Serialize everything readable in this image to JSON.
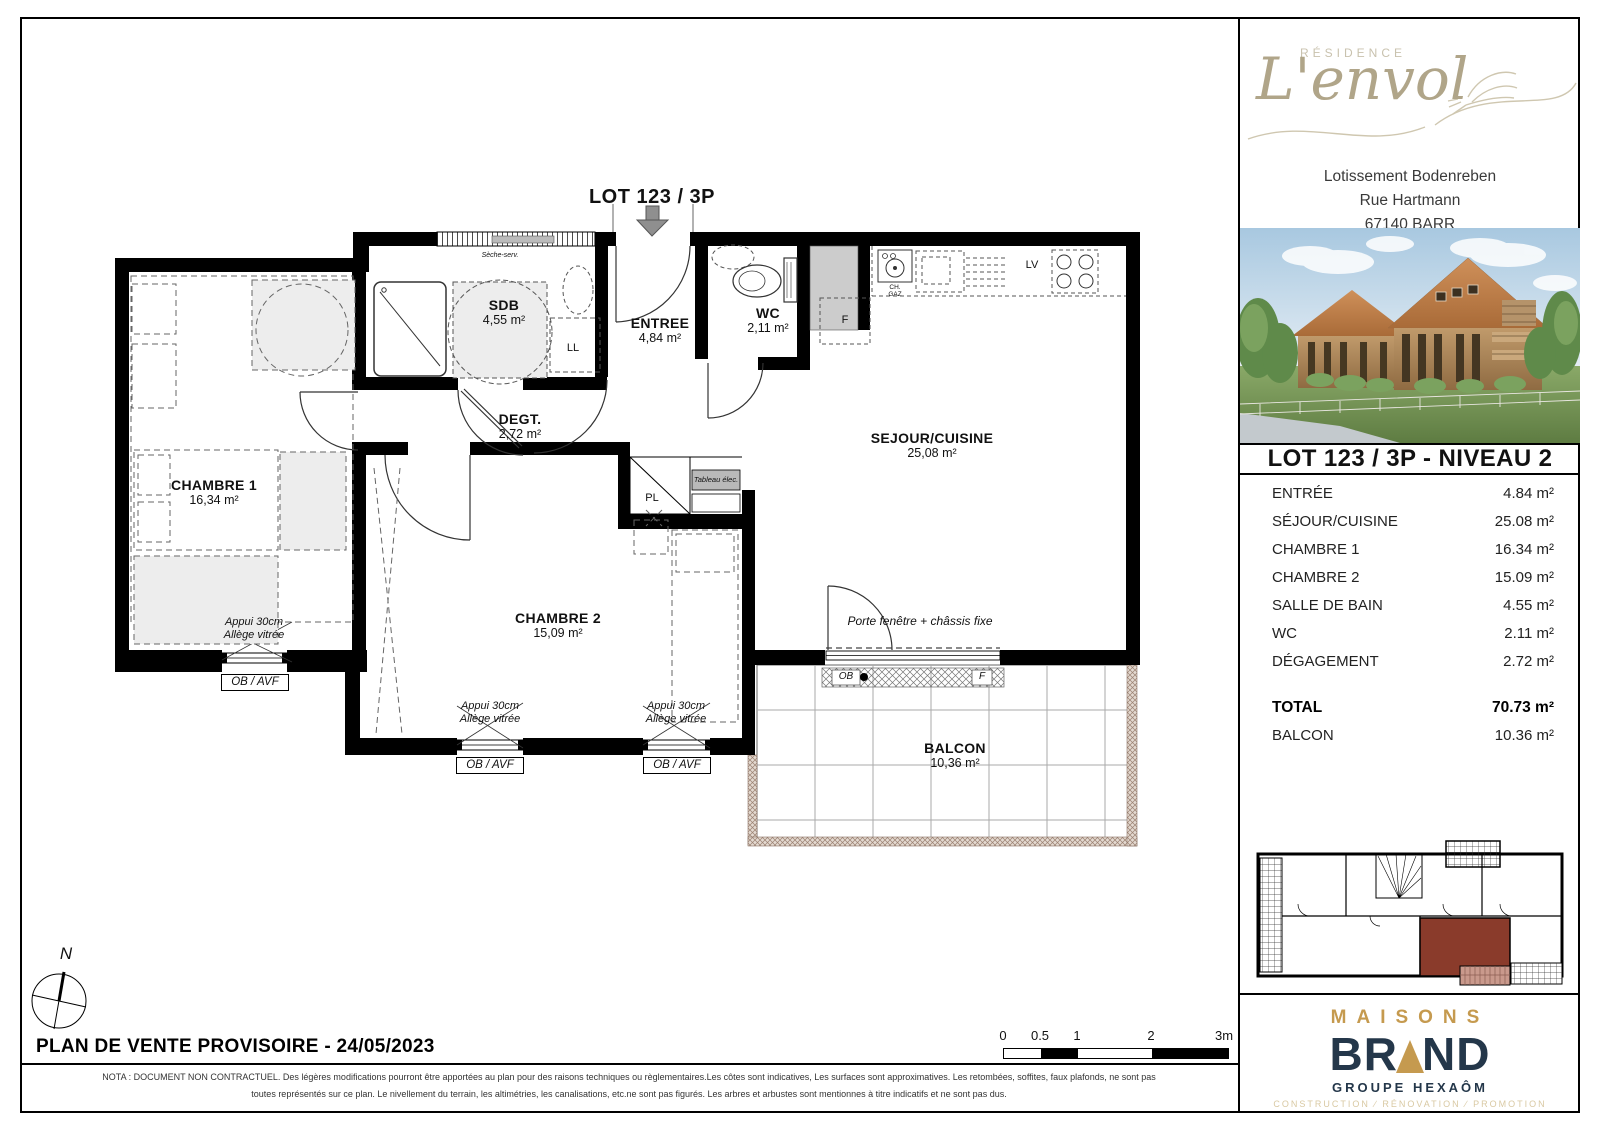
{
  "plan": {
    "lot_header": "LOT 123 / 3P",
    "rooms": [
      {
        "name": "CHAMBRE 1",
        "area": "16,34 m²"
      },
      {
        "name": "SDB",
        "area": "4,55 m²"
      },
      {
        "name": "ENTREE",
        "area": "4,84 m²"
      },
      {
        "name": "WC",
        "area": "2,11 m²"
      },
      {
        "name": "SEJOUR/CUISINE",
        "area": "25,08 m²"
      },
      {
        "name": "DEGT.",
        "area": "2,72 m²"
      },
      {
        "name": "CHAMBRE 2",
        "area": "15,09 m²"
      },
      {
        "name": "BALCON",
        "area": "10,36 m²"
      }
    ],
    "annotations": {
      "seche_serviette": "Sèche-serv.",
      "lave_linge": "LL",
      "frigo": "F",
      "lave_vaisselle": "LV",
      "chaudiere_gaz": "CH. GAZ",
      "placard": "PL",
      "tableau_elec": "Tableau élec.",
      "porte_fenetre": "Porte fenêtre + châssis fixe",
      "appui": "Appui 30cm",
      "allege": "Allège vitrée",
      "ob_avf": "OB / AVF",
      "ob": "OB",
      "f_fixe": "F",
      "north": "N"
    }
  },
  "footer": {
    "title": "PLAN DE VENTE PROVISOIRE - 24/05/2023",
    "scale_ticks": [
      "0",
      "0.5",
      "1",
      "2",
      "3m"
    ],
    "nota_line1": "NOTA : DOCUMENT NON CONTRACTUEL. Des légères modifications pourront être apportées au plan pour des raisons techniques ou règlementaires.Les côtes sont indicatives, Les surfaces sont approximatives. Les retombées, soffites, faux plafonds, ne sont pas",
    "nota_line2": "toutes représentés sur ce plan. Le nivellement du terrain, les altimétries, les canalisations, etc.ne sont pas figurés. Les arbres et arbustes sont mentionnes à titre indicatifs et ne sont pas dus."
  },
  "sidebar": {
    "residence_label": "RÉSIDENCE",
    "residence_name": "L'envol",
    "address_line1": "Lotissement Bodenreben",
    "address_line2": "Rue Hartmann",
    "address_line3": "67140 BARR",
    "lot_title": "LOT 123 / 3P - NIVEAU 2",
    "area_rows": [
      {
        "label": "ENTRÉE",
        "value": "4.84 m²"
      },
      {
        "label": "SÉJOUR/CUISINE",
        "value": "25.08 m²"
      },
      {
        "label": "CHAMBRE 1",
        "value": "16.34 m²"
      },
      {
        "label": "CHAMBRE 2",
        "value": "15.09 m²"
      },
      {
        "label": "SALLE DE BAIN",
        "value": "4.55 m²"
      },
      {
        "label": "WC",
        "value": "2.11 m²"
      },
      {
        "label": "DÉGAGEMENT",
        "value": "2.72 m²"
      }
    ],
    "total_row": {
      "label": "TOTAL",
      "value": "70.73 m²"
    },
    "balcony_row": {
      "label": "BALCON",
      "value": "10.36 m²"
    },
    "brand": {
      "maisons": "MAISONS",
      "brand_left": "BR",
      "brand_right": "ND",
      "groupe": "GROUPE HEXAÔM",
      "tagline": "CONSTRUCTION ∕ RÉNOVATION ∕ PROMOTION"
    }
  },
  "colors": {
    "brand_gold": "#C59A4F",
    "brand_navy": "#24374A",
    "tagline_gold": "#D9C9A3",
    "logo_taupe": "#B0A589",
    "highlight_unit": "#8A3B2B"
  }
}
